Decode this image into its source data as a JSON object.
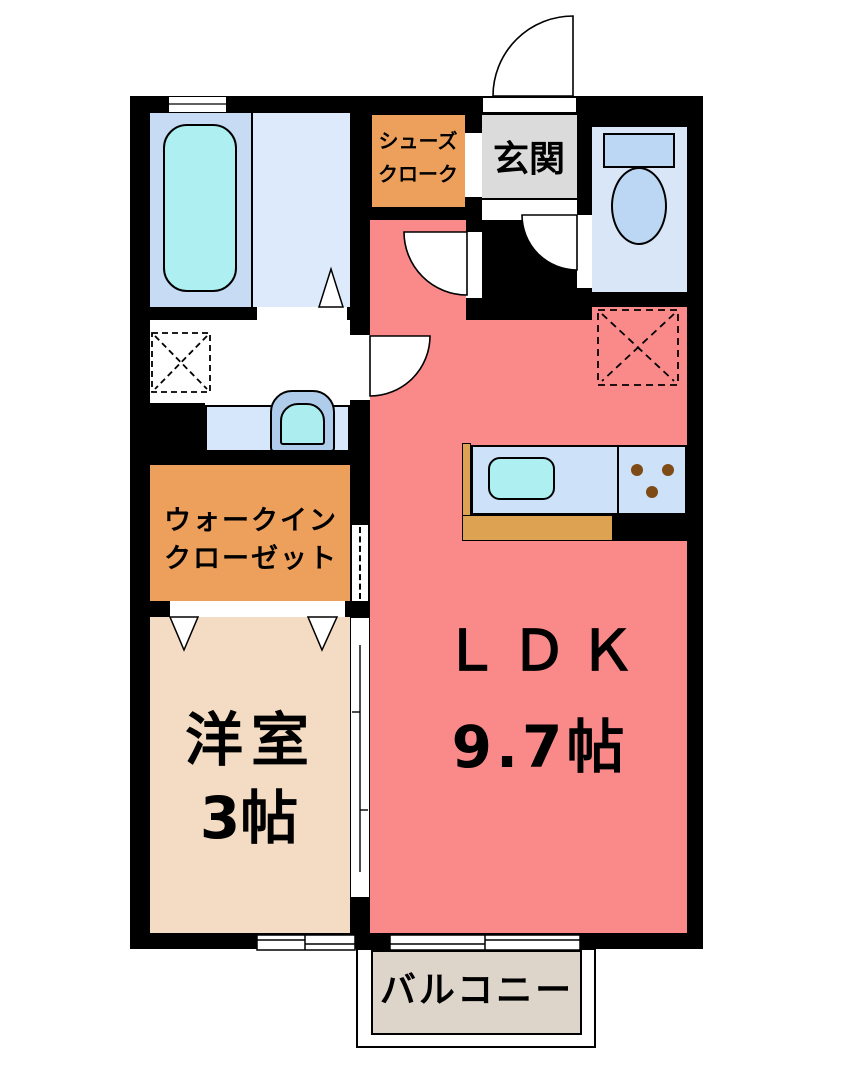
{
  "plan_title": "1LDK apartment floor plan",
  "rooms": {
    "ldk": {
      "name": "ＬＤＫ",
      "size": "9.7帖"
    },
    "western_room": {
      "name": "洋室",
      "size": "3帖"
    },
    "walk_in_closet": {
      "line1": "ウォークイン",
      "line2": "クローゼット"
    },
    "shoe_cloak": {
      "line1": "シューズ",
      "line2": "クローク"
    },
    "entrance": {
      "name": "玄関"
    },
    "balcony": {
      "name": "バルコニー"
    }
  },
  "fixtures": {
    "bathtub": "bathtub-icon",
    "toilet": "toilet-icon",
    "wash_basin": "wash-basin-icon",
    "washing_machine_space": "washing-machine-space-icon",
    "refrigerator_space": "refrigerator-space-icon",
    "kitchen_sink": "kitchen-sink-icon",
    "gas_stove": "gas-stove-icon",
    "doors": "door-swing-arc-icon",
    "sliding_door": "sliding-door-icon",
    "windows": "window-icon"
  },
  "colors": {
    "wall": "#000000",
    "ldk_floor": "#fa8a8a",
    "western_room_floor": "#f3dcc3",
    "closet_orange": "#eda05c",
    "kitchen_counter_orange": "#dda353",
    "entrance_gray": "#dbdbdb",
    "balcony_gray": "#ddd5ca",
    "bath_blue": "#c8dbf4",
    "bath_floor_blue": "#ddeafc",
    "toilet_blue": "#d8e6f8",
    "fixture_blue": "#bcd7f3",
    "water_cyan": "#aef0f2",
    "counter_blue": "#cde1f8",
    "burner_brown": "#7e4a15"
  }
}
